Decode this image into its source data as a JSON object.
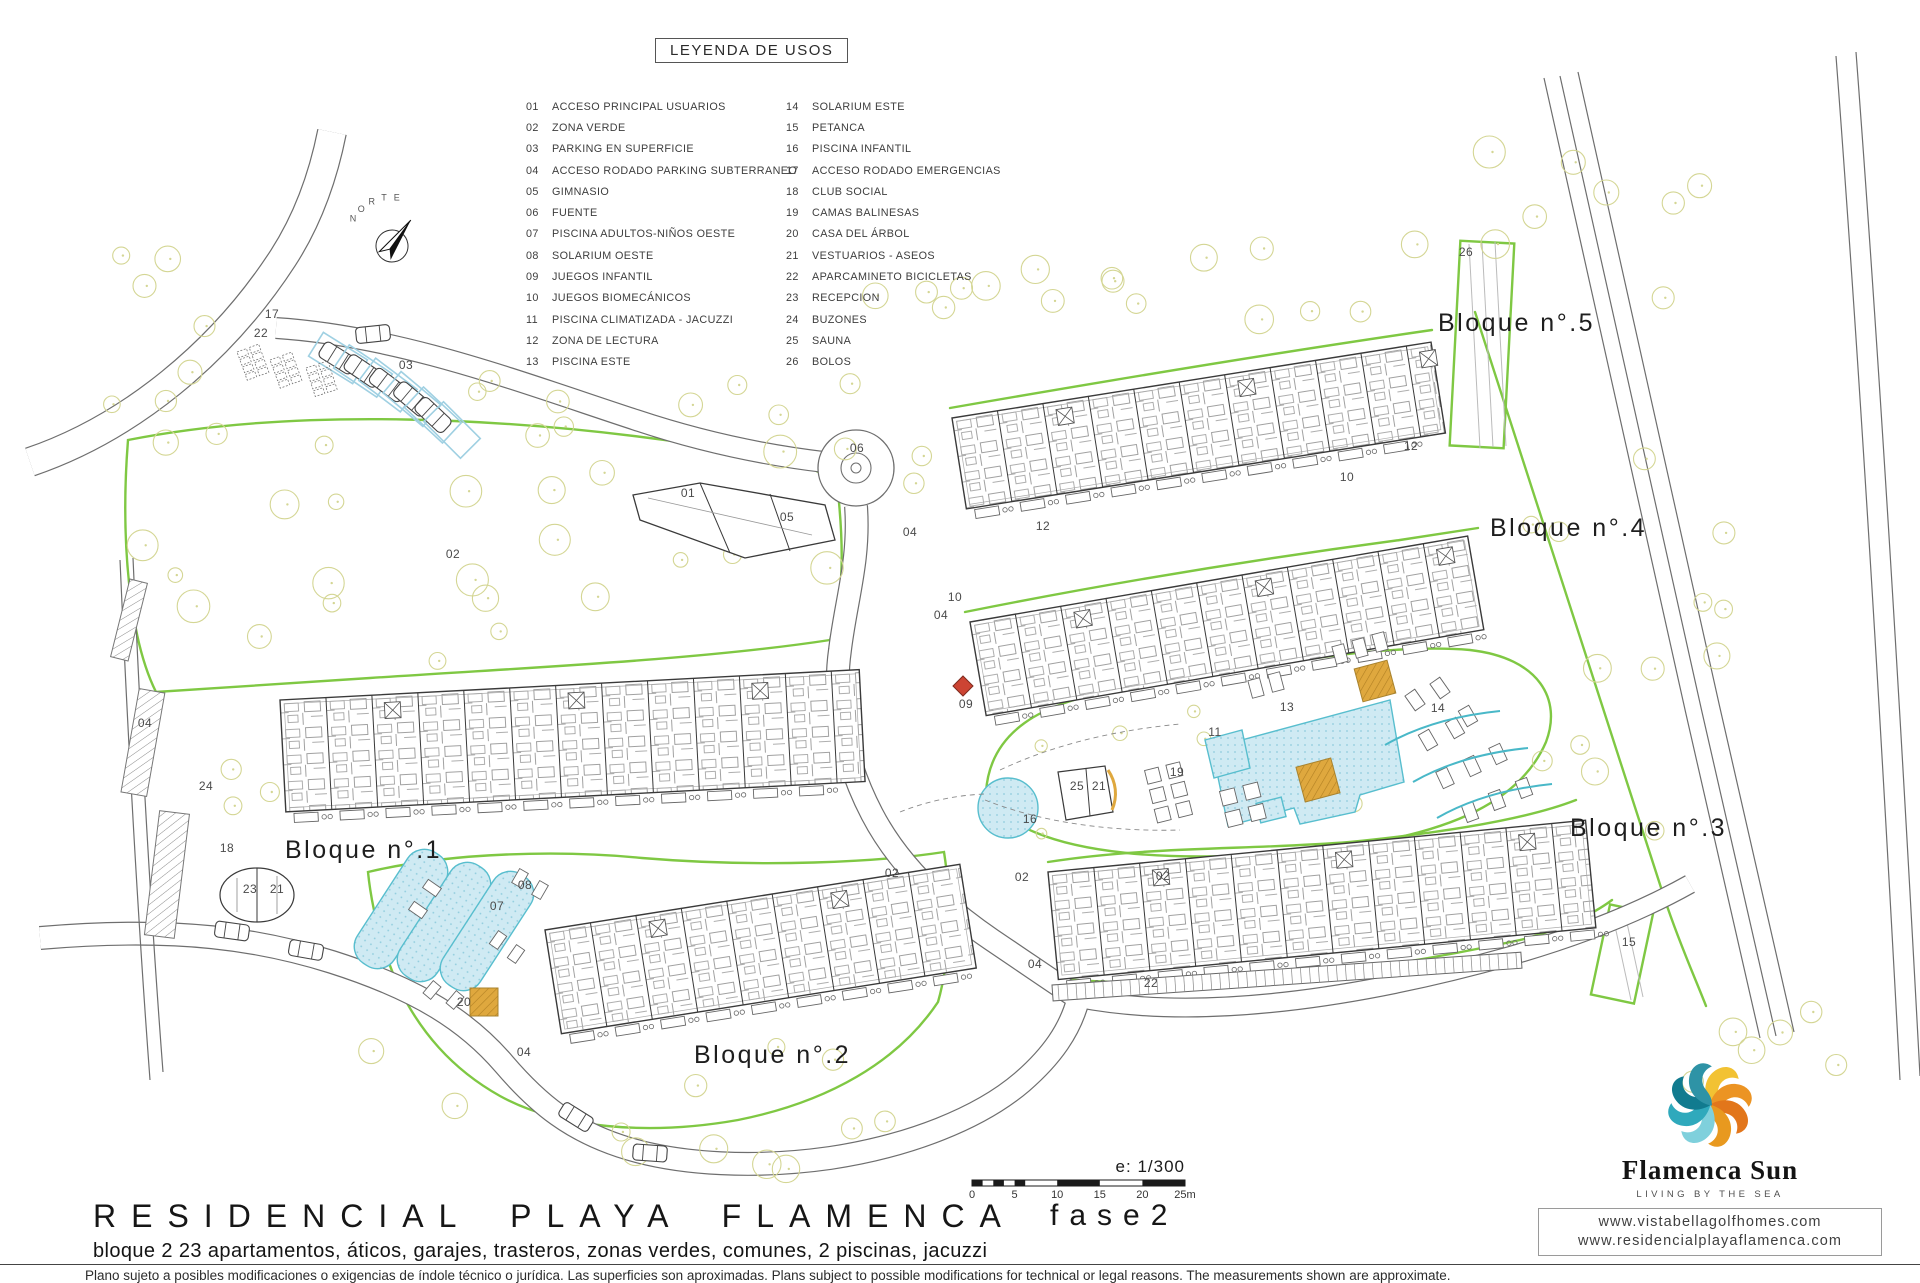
{
  "legend": {
    "title": "LEYENDA DE USOS",
    "items_left": [
      {
        "num": "01",
        "label": "ACCESO PRINCIPAL USUARIOS"
      },
      {
        "num": "02",
        "label": "ZONA VERDE"
      },
      {
        "num": "03",
        "label": "PARKING EN SUPERFICIE"
      },
      {
        "num": "04",
        "label": "ACCESO RODADO PARKING SUBTERRANEO"
      },
      {
        "num": "05",
        "label": "GIMNASIO"
      },
      {
        "num": "06",
        "label": "FUENTE"
      },
      {
        "num": "07",
        "label": "PISCINA ADULTOS-NIÑOS OESTE"
      },
      {
        "num": "08",
        "label": "SOLARIUM OESTE"
      },
      {
        "num": "09",
        "label": "JUEGOS INFANTIL"
      },
      {
        "num": "10",
        "label": "JUEGOS BIOMECÁNICOS"
      },
      {
        "num": "11",
        "label": "PISCINA CLIMATIZADA - JACUZZI"
      },
      {
        "num": "12",
        "label": "ZONA DE LECTURA"
      },
      {
        "num": "13",
        "label": "PISCINA ESTE"
      }
    ],
    "items_right": [
      {
        "num": "14",
        "label": "SOLARIUM ESTE"
      },
      {
        "num": "15",
        "label": "PETANCA"
      },
      {
        "num": "16",
        "label": "PISCINA INFANTIL"
      },
      {
        "num": "17",
        "label": "ACCESO RODADO EMERGENCIAS"
      },
      {
        "num": "18",
        "label": "CLUB SOCIAL"
      },
      {
        "num": "19",
        "label": "CAMAS BALINESAS"
      },
      {
        "num": "20",
        "label": "CASA DEL ÁRBOL"
      },
      {
        "num": "21",
        "label": "VESTUARIOS - ASEOS"
      },
      {
        "num": "22",
        "label": "APARCAMINETO BICICLETAS"
      },
      {
        "num": "23",
        "label": "RECEPCION"
      },
      {
        "num": "24",
        "label": "BUZONES"
      },
      {
        "num": "25",
        "label": "SAUNA"
      },
      {
        "num": "26",
        "label": "BOLOS"
      }
    ]
  },
  "plan": {
    "compass_label": "NORTE",
    "block_labels": [
      {
        "text": "Bloque n°.1",
        "x": 285,
        "y": 858
      },
      {
        "text": "Bloque n°.2",
        "x": 694,
        "y": 1063
      },
      {
        "text": "Bloque n°.3",
        "x": 1570,
        "y": 836
      },
      {
        "text": "Bloque n°.4",
        "x": 1490,
        "y": 536
      },
      {
        "text": "Bloque n°.5",
        "x": 1438,
        "y": 331
      }
    ],
    "annotations": [
      {
        "n": "17",
        "x": 272,
        "y": 318
      },
      {
        "n": "22",
        "x": 261,
        "y": 337
      },
      {
        "n": "03",
        "x": 406,
        "y": 369
      },
      {
        "n": "02",
        "x": 453,
        "y": 558
      },
      {
        "n": "01",
        "x": 688,
        "y": 497
      },
      {
        "n": "05",
        "x": 787,
        "y": 521
      },
      {
        "n": "06",
        "x": 857,
        "y": 452
      },
      {
        "n": "04",
        "x": 145,
        "y": 727
      },
      {
        "n": "24",
        "x": 206,
        "y": 790
      },
      {
        "n": "18",
        "x": 227,
        "y": 852
      },
      {
        "n": "23",
        "x": 250,
        "y": 893
      },
      {
        "n": "21",
        "x": 277,
        "y": 893
      },
      {
        "n": "08",
        "x": 525,
        "y": 889
      },
      {
        "n": "07",
        "x": 497,
        "y": 910
      },
      {
        "n": "20",
        "x": 464,
        "y": 1006
      },
      {
        "n": "04",
        "x": 524,
        "y": 1056
      },
      {
        "n": "02",
        "x": 892,
        "y": 877
      },
      {
        "n": "04",
        "x": 910,
        "y": 536
      },
      {
        "n": "12",
        "x": 1043,
        "y": 530
      },
      {
        "n": "10",
        "x": 955,
        "y": 601
      },
      {
        "n": "04",
        "x": 941,
        "y": 619
      },
      {
        "n": "09",
        "x": 966,
        "y": 708
      },
      {
        "n": "12",
        "x": 1411,
        "y": 450
      },
      {
        "n": "10",
        "x": 1347,
        "y": 481
      },
      {
        "n": "02",
        "x": 1022,
        "y": 881
      },
      {
        "n": "16",
        "x": 1030,
        "y": 823
      },
      {
        "n": "19",
        "x": 1177,
        "y": 776
      },
      {
        "n": "25",
        "x": 1077,
        "y": 790
      },
      {
        "n": "21",
        "x": 1099,
        "y": 790
      },
      {
        "n": "13",
        "x": 1287,
        "y": 711
      },
      {
        "n": "11",
        "x": 1215,
        "y": 736
      },
      {
        "n": "14",
        "x": 1438,
        "y": 712
      },
      {
        "n": "04",
        "x": 1035,
        "y": 968
      },
      {
        "n": "22",
        "x": 1151,
        "y": 987
      },
      {
        "n": "15",
        "x": 1629,
        "y": 946
      },
      {
        "n": "26",
        "x": 1466,
        "y": 256
      },
      {
        "n": "02",
        "x": 1163,
        "y": 880
      }
    ]
  },
  "scale": {
    "label": "e: 1/300",
    "ticks": [
      "0",
      "5",
      "10",
      "15",
      "20",
      "25m"
    ]
  },
  "title_block": {
    "title": "RESIDENCIAL PLAYA FLAMENCA",
    "phase": "fase2",
    "subtitle": "bloque 2   23 apartamentos, áticos, garajes, trasteros, zonas verdes, comunes, 2 piscinas, jacuzzi",
    "disclaimer": "Plano sujeto a posibles modificaciones o exigencias de índole técnico o jurídica. Las superficies son aproximadas.  Plans subject to possible modifications for technical or legal reasons.  The measurements shown are approximate."
  },
  "logo": {
    "name": "Flamenca Sun",
    "tagline": "LIVING BY THE SEA",
    "urls": [
      "www.vistabellagolfhomes.com",
      "www.residencialplayaflamenca.com"
    ],
    "petal_colors": [
      "#F2C233",
      "#EC9423",
      "#E2761B",
      "#E8991F",
      "#7FD0DC",
      "#2FA9BC",
      "#117B8F",
      "#2E93A6"
    ]
  },
  "colors": {
    "green": "#7fc843",
    "tree": "#d4d694",
    "pool_fill": "#cfeaf3",
    "pool_stroke": "#58bece",
    "orange": "#dfa83e",
    "road": "#6e6e6e",
    "building": "#3a3a3a",
    "annotation": "#4a4a4a"
  }
}
